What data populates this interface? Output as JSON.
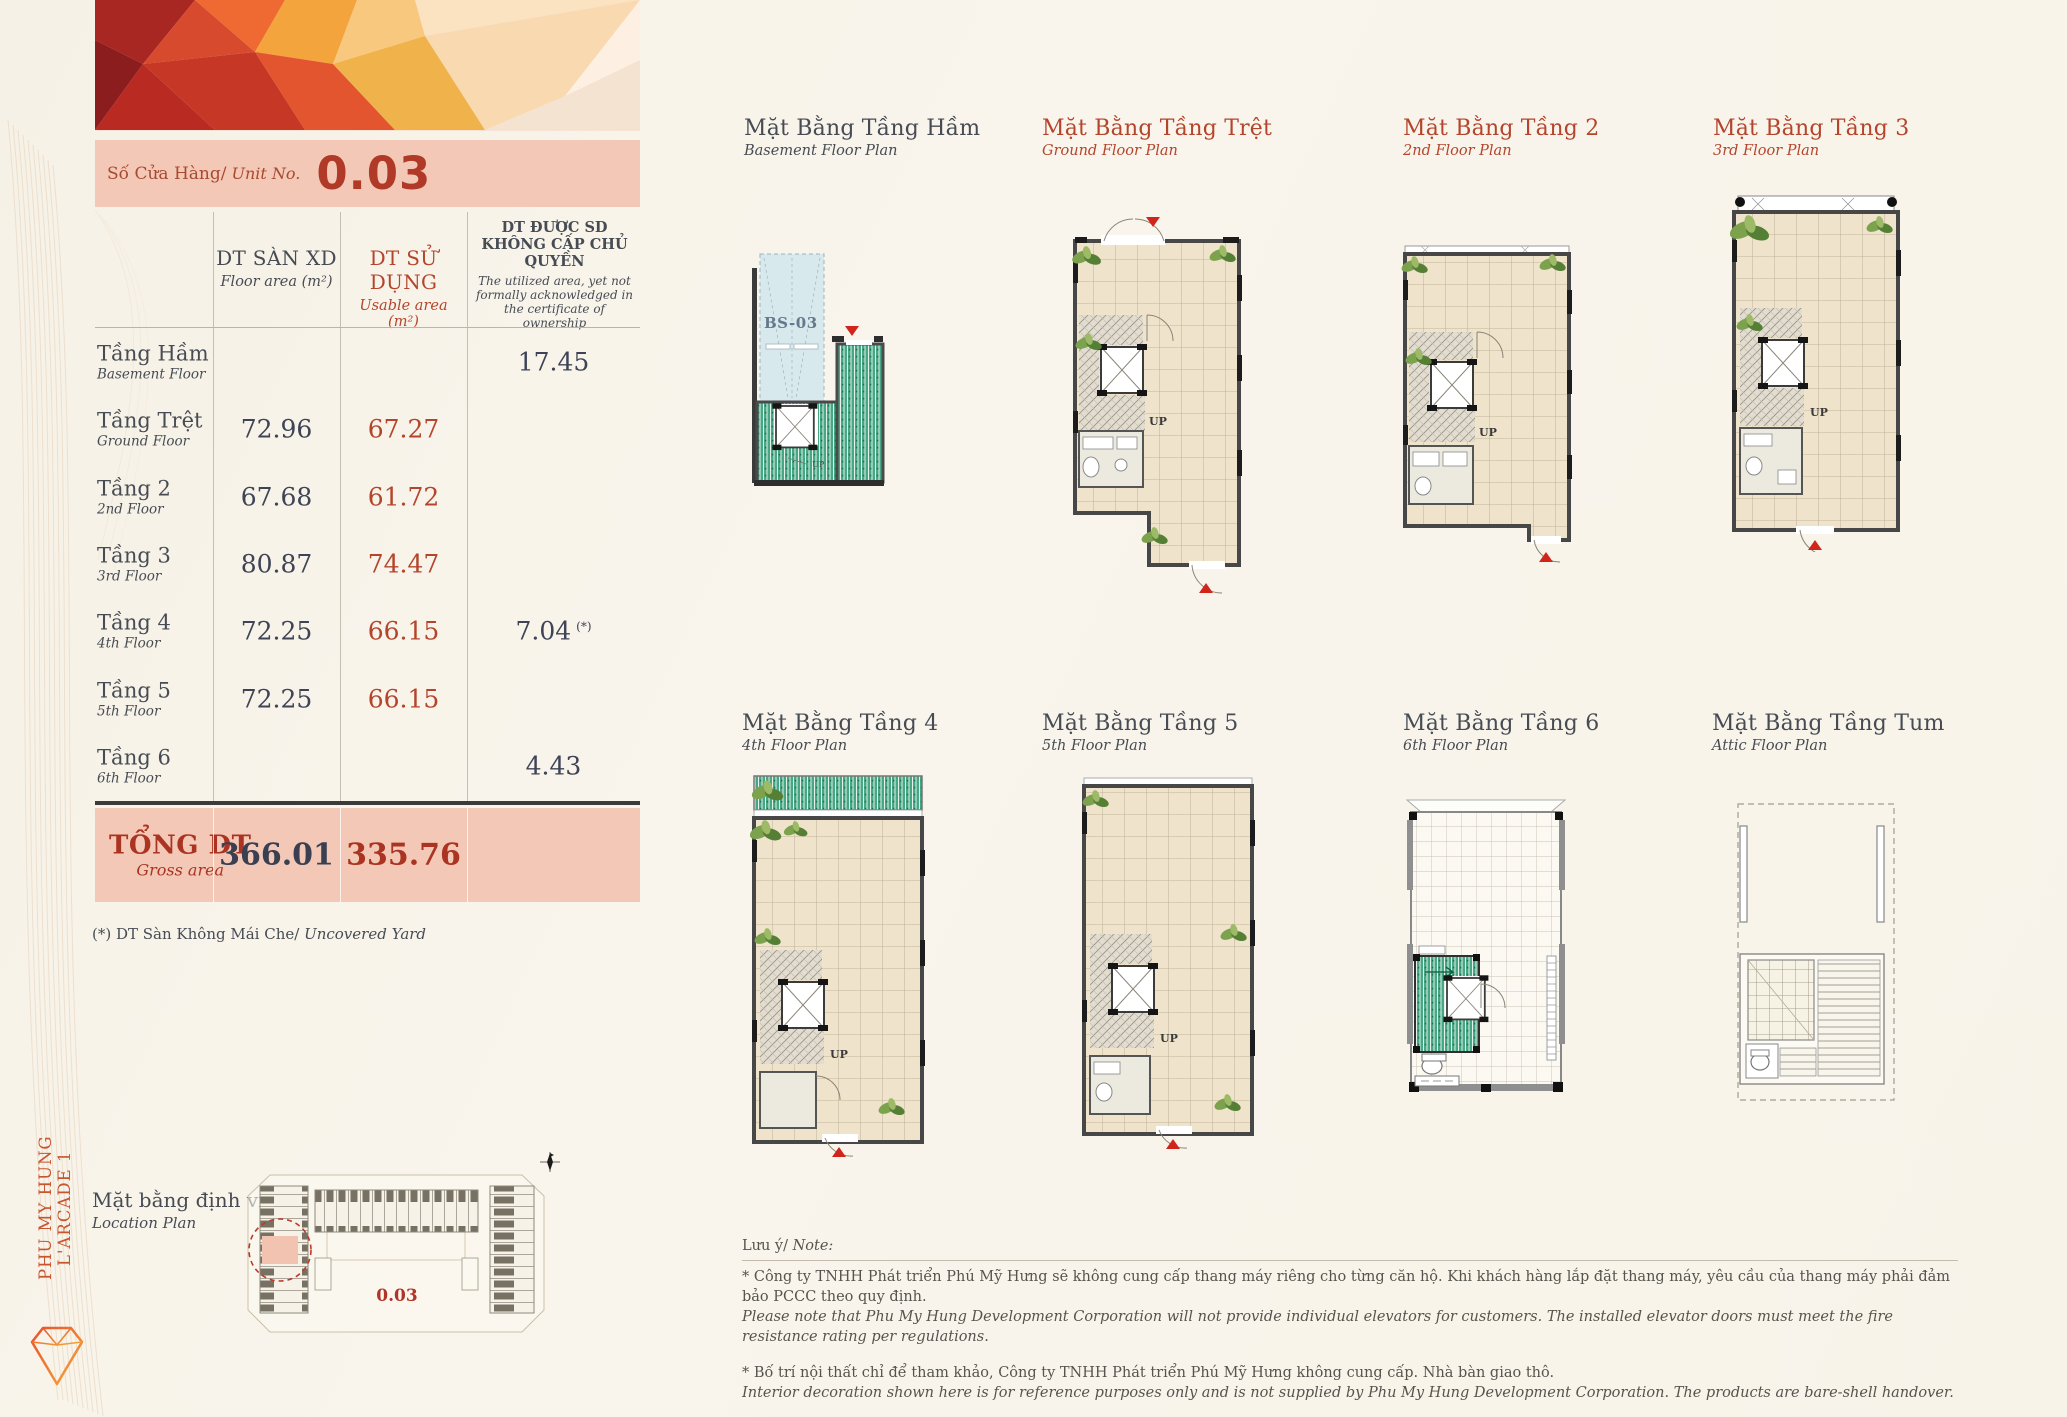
{
  "brand": {
    "vertical_text": "PHU MY HUNG L'ARCADE 1"
  },
  "unit_bar": {
    "label_vn": "Số Cửa Hàng/",
    "label_en": "Unit No.",
    "number": "0.03"
  },
  "table": {
    "col_floor": {
      "vn": "DT SÀN XD",
      "en": "Floor area (m²)"
    },
    "col_usable": {
      "vn": "DT SỬ DỤNG",
      "en": "Usable area (m²)"
    },
    "col_unack": {
      "vn": "DT ĐƯỢC SD KHÔNG CẤP CHỦ QUYỀN",
      "en": "The utilized area, yet not formally acknowledged in the certificate of ownership"
    },
    "rows": [
      {
        "vn": "Tầng Hầm",
        "en": "Basement Floor",
        "floor": "",
        "usable": "",
        "unack": "17.45",
        "mark": ""
      },
      {
        "vn": "Tầng Trệt",
        "en": "Ground Floor",
        "floor": "72.96",
        "usable": "67.27",
        "unack": "",
        "mark": ""
      },
      {
        "vn": "Tầng 2",
        "en": "2nd Floor",
        "floor": "67.68",
        "usable": "61.72",
        "unack": "",
        "mark": ""
      },
      {
        "vn": "Tầng 3",
        "en": "3rd Floor",
        "floor": "80.87",
        "usable": "74.47",
        "unack": "",
        "mark": ""
      },
      {
        "vn": "Tầng 4",
        "en": "4th Floor",
        "floor": "72.25",
        "usable": "66.15",
        "unack": "7.04",
        "mark": "(*)"
      },
      {
        "vn": "Tầng 5",
        "en": "5th Floor",
        "floor": "72.25",
        "usable": "66.15",
        "unack": "",
        "mark": ""
      },
      {
        "vn": "Tầng 6",
        "en": "6th Floor",
        "floor": "",
        "usable": "",
        "unack": "4.43",
        "mark": ""
      }
    ],
    "total": {
      "vn": "TỔNG DT",
      "en": "Gross area",
      "floor": "366.01",
      "usable": "335.76"
    },
    "footnote_vn": "(*) DT Sàn Không Mái Che/",
    "footnote_en": "Uncovered Yard"
  },
  "location": {
    "title_vn": "Mặt bằng định vị",
    "title_en": "Location Plan",
    "unit_label": "0.03"
  },
  "plans": [
    {
      "title_vn": "Mặt Bằng Tầng Hầm",
      "title_en": "Basement Floor Plan"
    },
    {
      "title_vn": "Mặt Bằng Tầng Trệt",
      "title_en": "Ground Floor Plan"
    },
    {
      "title_vn": "Mặt Bằng Tầng 2",
      "title_en": "2nd Floor Plan"
    },
    {
      "title_vn": "Mặt Bằng Tầng 3",
      "title_en": "3rd Floor Plan"
    },
    {
      "title_vn": "Mặt Bằng Tầng 4",
      "title_en": "4th Floor Plan"
    },
    {
      "title_vn": "Mặt Bằng Tầng 5",
      "title_en": "5th Floor Plan"
    },
    {
      "title_vn": "Mặt Bằng Tầng 6",
      "title_en": "6th Floor Plan"
    },
    {
      "title_vn": "Mặt Bằng Tầng Tum",
      "title_en": "Attic Floor Plan"
    }
  ],
  "plan_labels": {
    "basement_unit": "BS-03",
    "up": "UP"
  },
  "notes": {
    "label_vn": "Lưu ý/",
    "label_en": "Note:",
    "note1_vn": "* Công ty TNHH Phát triển Phú Mỹ Hưng sẽ không cung cấp thang máy riêng cho từng căn hộ. Khi khách hàng lắp đặt thang máy, yêu cầu của thang máy phải đảm bảo PCCC theo quy định.",
    "note1_en": "Please note that Phu My Hung Development Corporation will not provide individual elevators for customers. The installed elevator doors must meet the fire resistance rating per regulations.",
    "note2_vn": "* Bố trí nội thất chỉ để tham khảo, Công ty TNHH Phát triển Phú Mỹ Hưng không cung cấp. Nhà bàn giao thô.",
    "note2_en": "Interior decoration shown here is for reference purposes only and is not supplied by Phu My Hung Development Corporation. The products are bare-shell handover."
  },
  "colors": {
    "accent_red": "#b4452c",
    "text_dark": "#474c54",
    "bar_pink": "#f3c8b6",
    "marker_red": "#d1251c",
    "hatch_green": "#3fa07c",
    "floor_beige": "#efe3cb",
    "parking_blue": "#d8e9ed",
    "value_dark": "#3e4456"
  }
}
